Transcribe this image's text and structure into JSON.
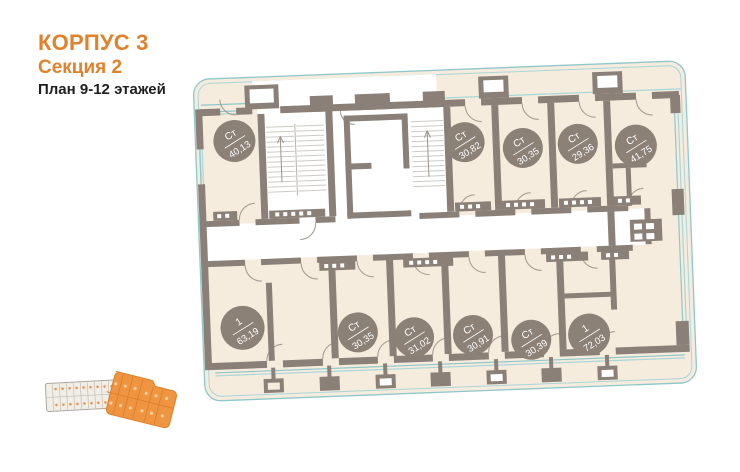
{
  "header": {
    "building": "КОРПУС 3",
    "section": "Секция 2",
    "floors_plan": "План 9-12 этажей"
  },
  "plan": {
    "units": [
      {
        "type": "Ст",
        "area": "40,13"
      },
      {
        "type": "Ст",
        "area": "30,82"
      },
      {
        "type": "Ст",
        "area": "30,35"
      },
      {
        "type": "Ст",
        "area": "29,36"
      },
      {
        "type": "Ст",
        "area": "41,75"
      },
      {
        "type": "1",
        "area": "63,19"
      },
      {
        "type": "Ст",
        "area": "30,35"
      },
      {
        "type": "Ст",
        "area": "31,02"
      },
      {
        "type": "Ст",
        "area": "30,91"
      },
      {
        "type": "Ст",
        "area": "30,39"
      },
      {
        "type": "1",
        "area": "72,03"
      }
    ],
    "colors": {
      "accent_orange": "#E0812B",
      "wall_gray": "#8A8078",
      "floor_beige": "#F5ECDE",
      "outline_teal": "#8FC7CB",
      "badge_fill": "#8B8177",
      "minimap_highlight": "#EF9542"
    }
  }
}
